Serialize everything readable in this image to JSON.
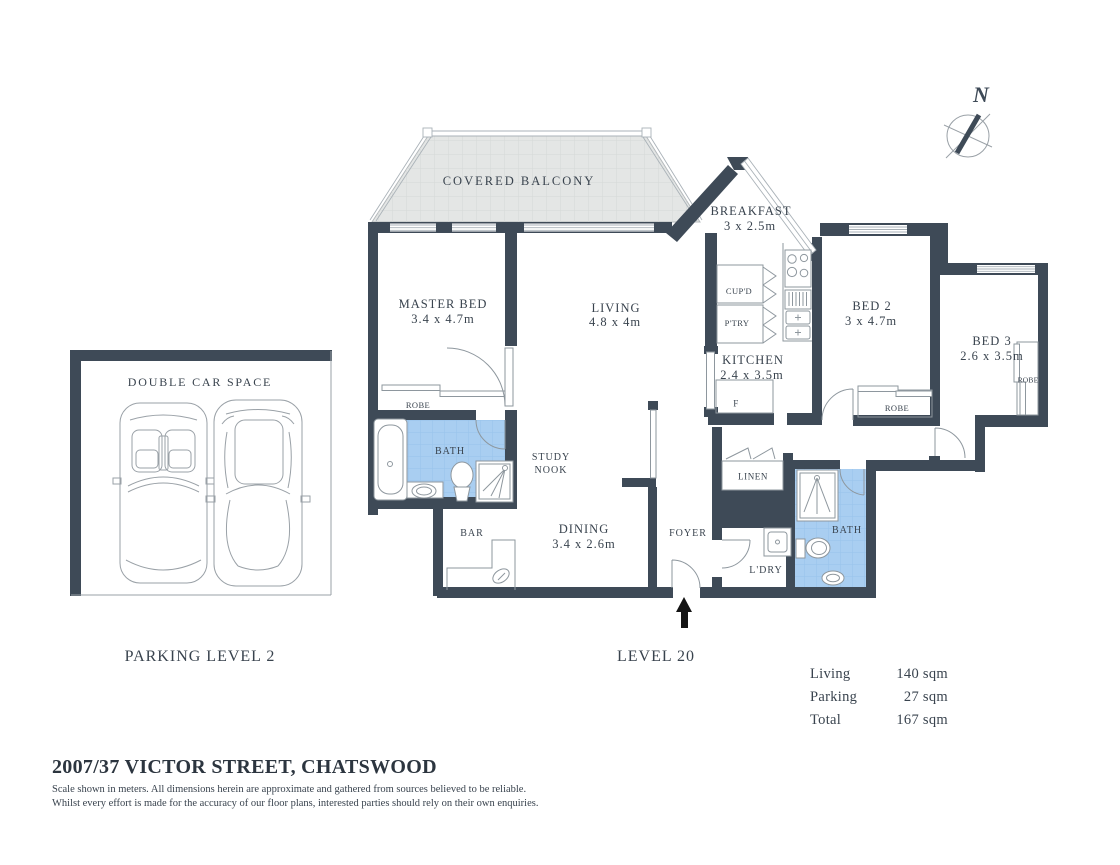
{
  "plan": {
    "balcony": "COVERED BALCONY",
    "master_bed": {
      "name": "MASTER BED",
      "dims": "3.4 x 4.7m"
    },
    "living": {
      "name": "LIVING",
      "dims": "4.8 x 4m"
    },
    "breakfast": {
      "name": "BREAKFAST",
      "dims": "3 x 2.5m"
    },
    "kitchen": {
      "name": "KITCHEN",
      "dims": "2.4 x 3.5m"
    },
    "bed2": {
      "name": "BED 2",
      "dims": "3 x 4.7m"
    },
    "bed3": {
      "name": "BED 3",
      "dims": "2.6 x 3.5m"
    },
    "dining": {
      "name": "DINING",
      "dims": "3.4 x 2.6m"
    },
    "study_nook": {
      "line1": "STUDY",
      "line2": "NOOK"
    },
    "bath_master": "BATH",
    "bath_main": "BATH",
    "bar": "BAR",
    "foyer": "FOYER",
    "linen": "LINEN",
    "laundry": "L'DRY",
    "cupboard": "CUP'D",
    "pantry": "P'TRY",
    "fridge": "F",
    "robe_master": "ROBE",
    "robe_bed2": "ROBE",
    "robe_bed3": "ROBE"
  },
  "floor": {
    "level_label": "LEVEL 20"
  },
  "parking": {
    "space_label": "DOUBLE CAR SPACE",
    "level_label": "PARKING LEVEL 2"
  },
  "compass": {
    "north_label": "N"
  },
  "area_summary": {
    "rows": [
      {
        "label": "Living",
        "value": "140 sqm"
      },
      {
        "label": "Parking",
        "value": "27 sqm"
      },
      {
        "label": "Total",
        "value": "167 sqm"
      }
    ]
  },
  "footer": {
    "address": "2007/37 VICTOR STREET, CHATSWOOD",
    "disclaimer1": "Scale shown in meters. All dimensions herein are approximate and gathered from sources believed to be  reliable.",
    "disclaimer2": "Whilst every effort is made for the accuracy of our floor plans, interested parties should rely on their own enquiries."
  },
  "colors": {
    "wall": "#3e4a57",
    "bath_floor": "#a9cef1",
    "balcony_floor": "#e4e6e5",
    "text": "#39434e",
    "line": "#8e979e",
    "window_line": "#aab2b8",
    "ink": "#141414"
  }
}
